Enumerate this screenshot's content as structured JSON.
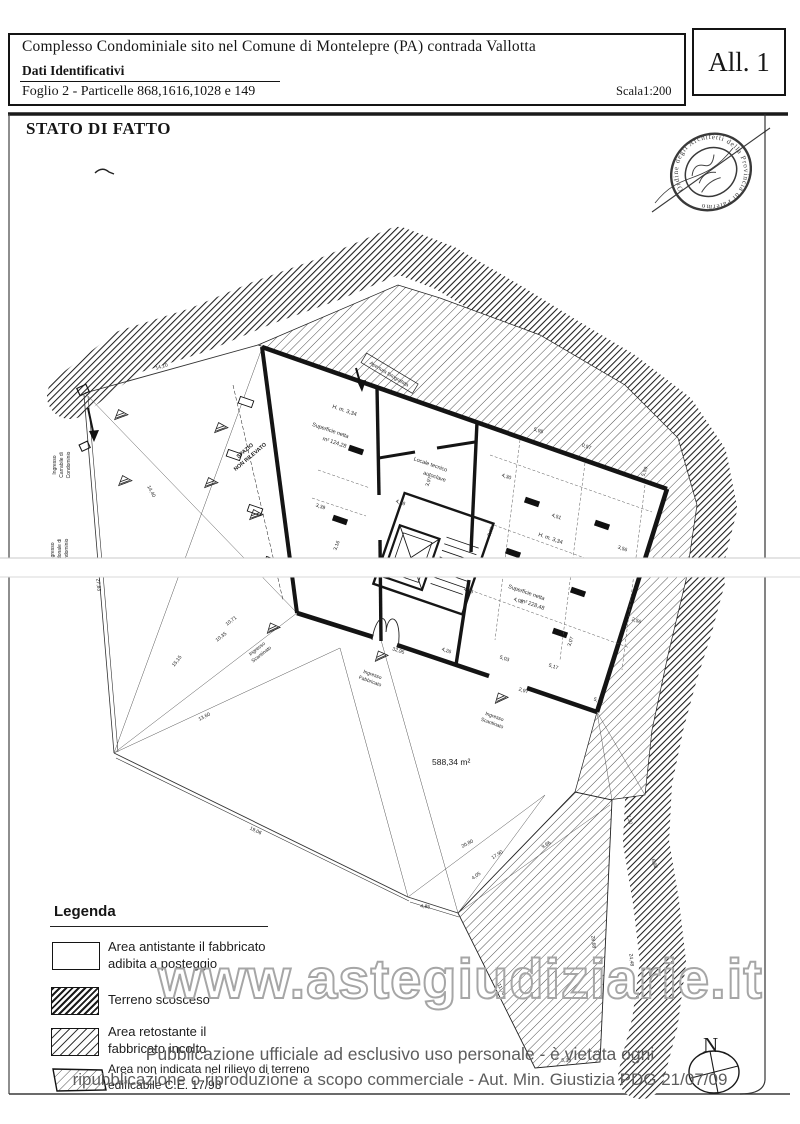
{
  "page": {
    "header": {
      "title": "Complesso Condominiale  sito nel Comune di Montelepre (PA) contrada Vallotta",
      "section_label": "Dati Identificativi",
      "sheet_info": "Foglio 2 - Particelle 868,1616,1028 e 149",
      "scale": "Scala1:200",
      "attachment": "All. 1"
    },
    "drawing_title": "STATO DI FATTO",
    "stamp_ring_text": "Ordine degli Architetti della Provincia di Palermo",
    "north_label": "N"
  },
  "plan": {
    "rooms": {
      "spazio_line1": "SPAZIO",
      "spazio_line2": "NON RILEVATO",
      "h1": "H. m. 3,34",
      "sup1_line1": "Superficie netta",
      "sup1_line2": "m² 124,28",
      "locale_line1": "Locale tecnico",
      "locale_line2": "autoclave",
      "h2": "H. m. 3,34",
      "sup2_line1": "Superficie netta",
      "sup2_line2": "m² 228,48",
      "apertura": "Apertura fotografata",
      "area_total": "588,34 m²"
    },
    "entrances": {
      "ingresso": "Ingresso",
      "carrabile": "Carrabile di",
      "pedonale": "Pedonale di",
      "condominio": "Condominio",
      "scantinato": "Scantinato",
      "fabbricato": "Fabbricato"
    },
    "dims": [
      "14,10",
      "14,40",
      "27,83",
      "15,15",
      "13,60",
      "10,71",
      "10,35",
      "19,06",
      "32,95",
      "4,85",
      "4,05",
      "20,80",
      "17,90",
      "9,66",
      "11,70",
      "28,68",
      "5,39",
      "7,20",
      "6,98",
      "24,48",
      "4,51",
      "3,92",
      "3,56",
      "4,30",
      "5,95",
      "4,02",
      "5,17",
      "2,97",
      "3,07",
      "2,56",
      "4,25",
      "4,26",
      "5,03",
      "3,39",
      "3,16",
      "5,59",
      "5,45",
      "3,97",
      "4,28",
      "0,57"
    ]
  },
  "legend": {
    "title": "Legenda",
    "items": [
      {
        "line1": "Area antistante il fabbricato",
        "line2": "adibita a posteggio"
      },
      {
        "line1": "Terreno scosceso",
        "line2": ""
      },
      {
        "line1": "Area retostante il",
        "line2": "fabbricato incolto"
      },
      {
        "line1": "Area non indicata nel rilievo di terreno",
        "line2": "edificabile C.E. 17/93"
      }
    ]
  },
  "watermark": "www.astegiudiziarie.it",
  "footer": {
    "line1": "Pubblicazione ufficiale ad esclusivo uso personale - è vietata ogni",
    "line2": "ripubblicazione o riproduzione a scopo commerciale - Aut. Min. Giustizia PDG 21/07/09"
  }
}
